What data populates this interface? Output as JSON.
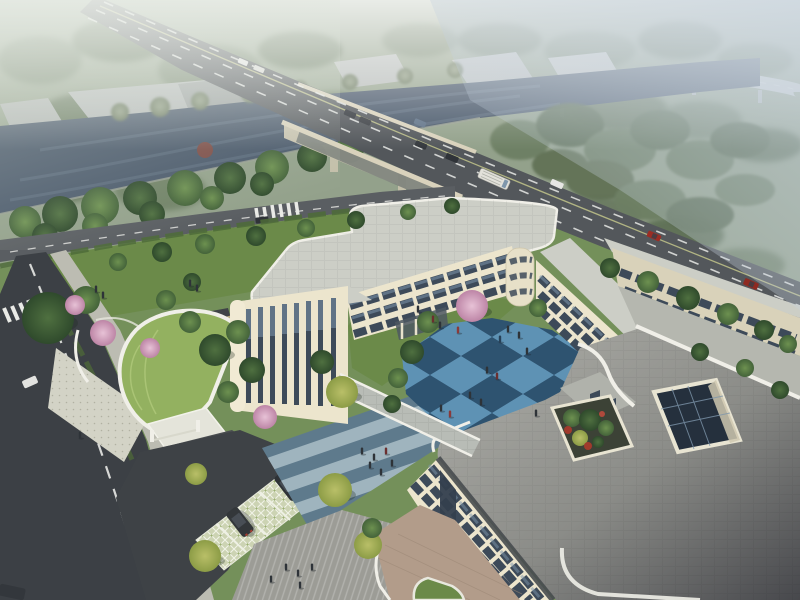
{
  "image": {
    "kind": "architectural aerial rendering",
    "width": 800,
    "height": 600,
    "visible_text": "none"
  },
  "palette": {
    "mist_field": "#93a18b",
    "haze_top": "#eef2f4",
    "haze_right": "#c6d2de",
    "river": "#49586a",
    "river_light": "#6b7c8e",
    "road_asphalt": "#53575b",
    "local_road": "#5a5e62",
    "street_dark": "#3c4045",
    "road_line": "#e8e9e6",
    "bridge_edge": "#d9d2bc",
    "sidewalk": "#bcbcb2",
    "entry_plaza": "#d3d3c6",
    "lawn_base": "#74905a",
    "lawn": "#6b8a49",
    "green_roof": "#93b160",
    "building_cream": "#ece5cd",
    "building_shade": "#d9d2ba",
    "window_dark": "#3d4a59",
    "window_blue": "#7e96ab",
    "roof_light": "#cccec6",
    "roof_mid": "#b5b7af",
    "roof_dark_edge": "#474b4f",
    "fascia_white": "#f0efe8",
    "court_blue_light": "#5e92b4",
    "court_blue_dark": "#2e5370",
    "plaza_light": "#9fb4be",
    "plaza_dark": "#5e7a8c",
    "plaza_gray": "#9c9c96",
    "terrace_tan": "#b29c8a",
    "grid_paver": "#ccd3b3",
    "skylight_glass": "#25303d",
    "car_red": "#9c2d24",
    "car_white": "#e6e6e4",
    "car_dark": "#33373c",
    "people_dark": "#2e3338"
  },
  "scene": {
    "environment": {
      "river": "dark canal running diagonally through the upper left, crossed by a road bridge",
      "main_road": "six-lane arterial road descending from the top left across the bridge to the right edge",
      "expressway": "elevated expressway curving through haze in the upper right",
      "riverside_road": "tree-lined local road along the south bank",
      "city_street": "dark two-lane street with dashed centreline along the left edge",
      "warehouses": "flat grey industrial sheds on the far river bank",
      "haze": "white atmospheric haze over the top third of the view"
    },
    "campus": {
      "building": "three-storey cream institutional complex with rounded corners around a central courtyard",
      "courtyard": "blue checkerboard plaza with lawn and a pink blossom tree",
      "wings": [
        "north wing",
        "west wing with vertical window strips",
        "east wing",
        "south block",
        "single-storey podium with paved roof"
      ],
      "roof_features": [
        "glazed atrium skylight",
        "rooftop planter with red and green shrubs",
        "stepped grey paved roofs",
        "curved green-roof entrance pavilion"
      ],
      "link": "paved covered walkway joining west wing and south block",
      "plazas": [
        "blue-grey striped pedestrian plaza",
        "grey stepped forecourt",
        "tan paved terrace"
      ],
      "parking": "grass-grid stalls beside the entrance drive with two dark SUVs",
      "entrance": "gated driveway from the west street"
    },
    "traffic": {
      "bridge_vehicles": 11,
      "street_vehicles": 4,
      "parked_suvs": 2,
      "vehicle_colors": [
        "white",
        "dark grey",
        "red",
        "blue"
      ]
    },
    "people": {
      "courtyard": 15,
      "striped_plaza": 6,
      "forecourt": 5,
      "garden_and_lawns": 5
    },
    "vegetation": {
      "blossom_trees": 5,
      "yellow_green_trees": 5,
      "tree_rows": "dense belts along both river banks and roads",
      "hedges": "clipped bands beside the roads",
      "green_roof": "curved lawn-covered pavilion roof"
    }
  }
}
